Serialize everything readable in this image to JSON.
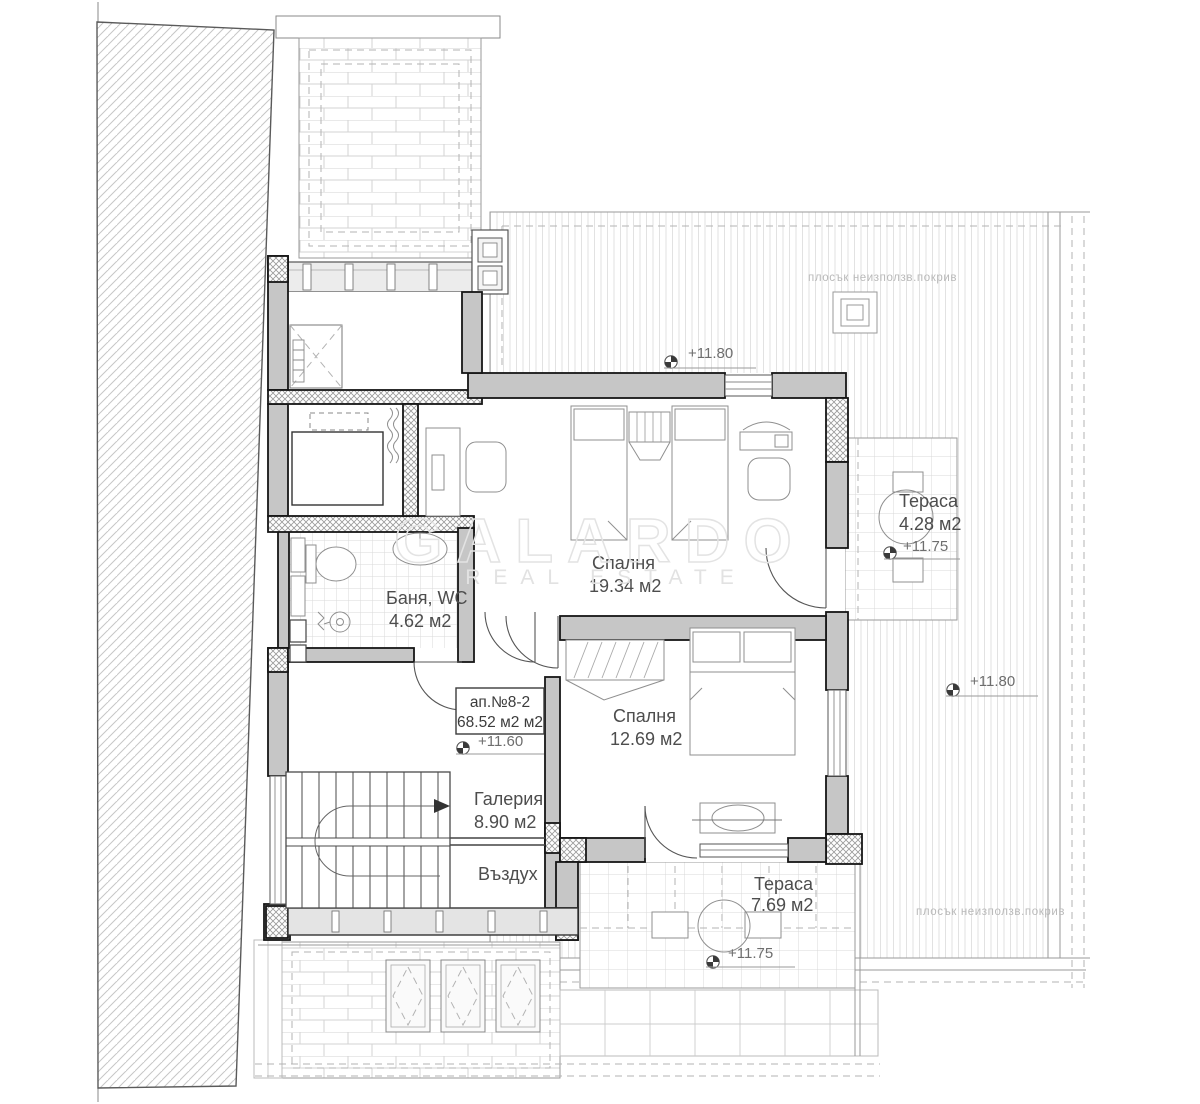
{
  "watermark": {
    "brand": "GALARDO",
    "tagline": "REAL ESTATE"
  },
  "apartment": {
    "number": "ап.№8-2",
    "total_area": "68.52 м2 м2",
    "level": "+11.60"
  },
  "rooms": {
    "bedroom_top": {
      "name": "Спалня",
      "area": "19.34 м2"
    },
    "bedroom_bottom": {
      "name": "Спалня",
      "area": "12.69 м2"
    },
    "bathroom": {
      "name": "Баня, WC",
      "area": "4.62 м2"
    },
    "gallery": {
      "name": "Галерия",
      "area": "8.90 м2"
    },
    "air_void": {
      "name": "Въздух"
    }
  },
  "terraces": {
    "east": {
      "name": "Тераса",
      "area": "4.28 м2",
      "level": "+11.75"
    },
    "south": {
      "name": "Тераса",
      "area": "7.69 м2",
      "level": "+11.75"
    }
  },
  "roof": {
    "note_top": "плосък неизползв.покрив",
    "note_bottom": "плосък неизползв.покрив",
    "level_top": "+11.80",
    "level_right": "+11.80"
  },
  "colors": {
    "wall_fill": "#c6c6c6",
    "wall_stroke": "#161616",
    "roof_line": "#e0e0e0",
    "label": "#4d4d4d",
    "muted": "#b9b9b9",
    "watermark": "#e3e3e3"
  }
}
